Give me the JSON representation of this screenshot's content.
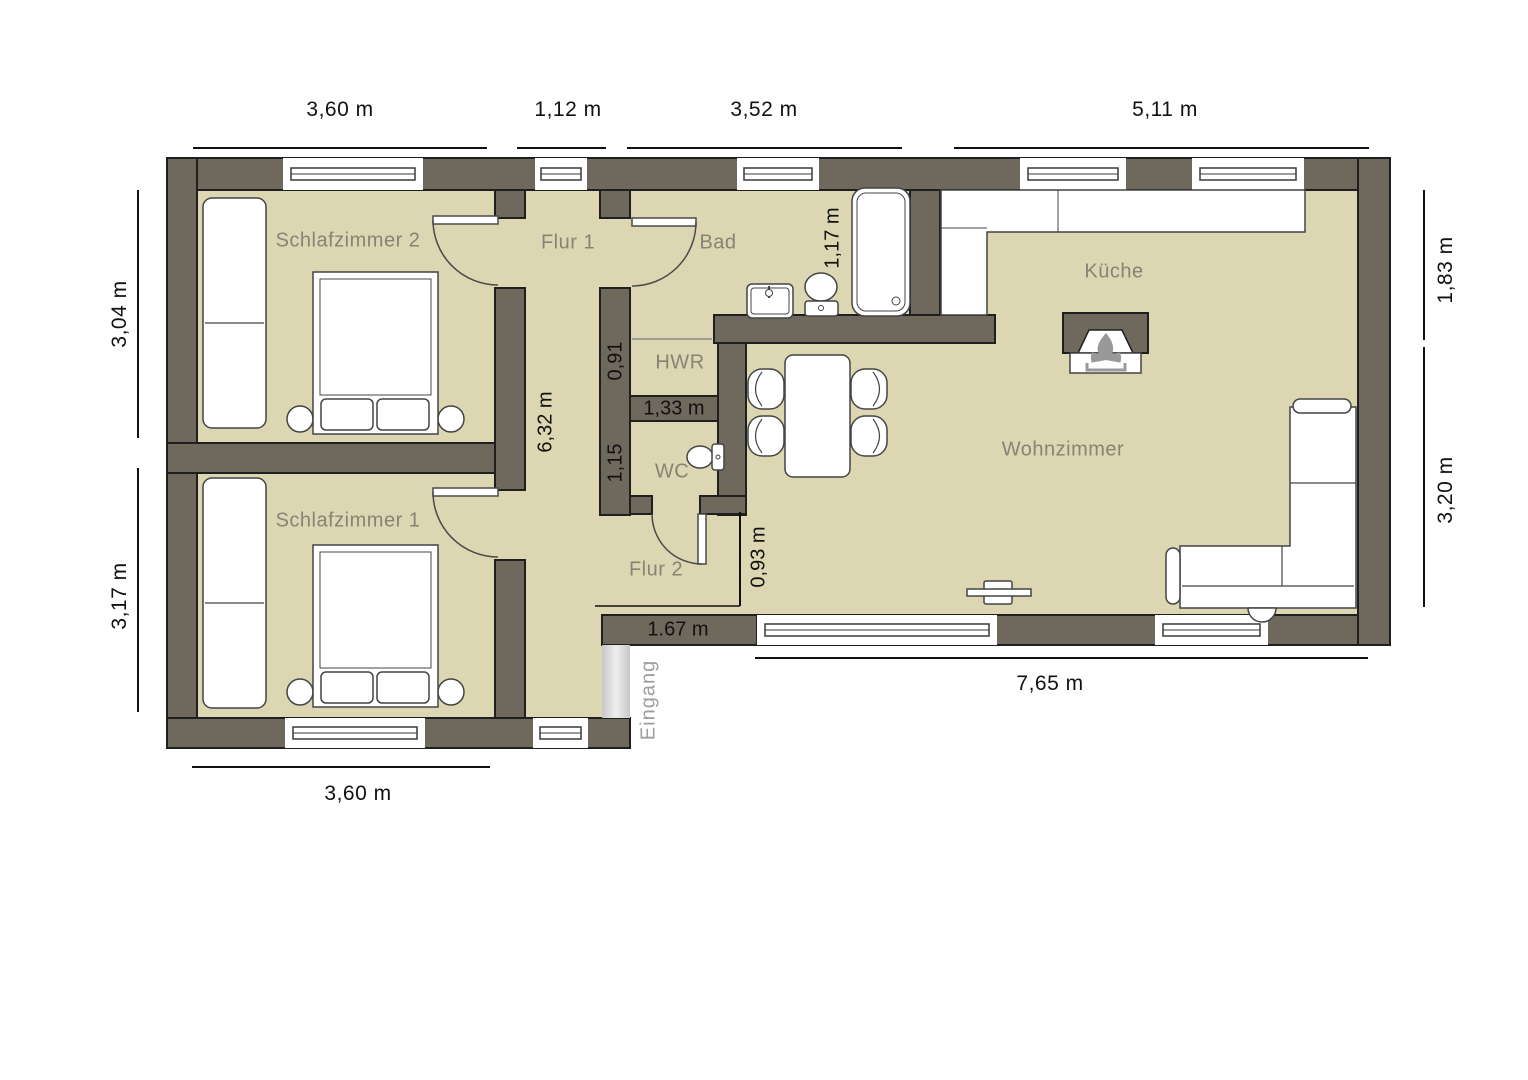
{
  "rooms": [
    {
      "label": "Schlafzimmer 2"
    },
    {
      "label": "Schlafzimmer 1"
    },
    {
      "label": "Flur 1"
    },
    {
      "label": "Flur 2"
    },
    {
      "label": "Bad"
    },
    {
      "label": "HWR"
    },
    {
      "label": "WC"
    },
    {
      "label": "Küche"
    },
    {
      "label": "Wohnzimmer"
    }
  ],
  "entrance": {
    "label": "Eingang"
  },
  "dimensions": {
    "top": [
      "3,60 m",
      "1,12 m",
      "3,52 m",
      "5,11 m"
    ],
    "left": [
      "3,04 m",
      "3,17 m"
    ],
    "right": [
      "1,83 m",
      "3,20 m"
    ],
    "bottom": [
      "7,65 m",
      "3,60 m"
    ],
    "interior": {
      "hall_length": "6,32 m",
      "bath_tub_width": "1,17 m",
      "hwr_width": "0,91",
      "wc_width": "1,15",
      "hwr_wc_wall": "1,33 m",
      "flur2_opening": "0,93 m",
      "entry_wall": "1.67 m"
    }
  },
  "icons": {
    "fireplace": "campfire-icon"
  },
  "colors": {
    "wall": "#6F685D",
    "floor": "#DCD6B2",
    "outline": "#1F1F1F",
    "room_label": "#8A8274",
    "dimension_label": "#111111",
    "entrance_label": "#9E9E9E",
    "furniture_outline": "#444444",
    "fire_icon": "#999999"
  }
}
